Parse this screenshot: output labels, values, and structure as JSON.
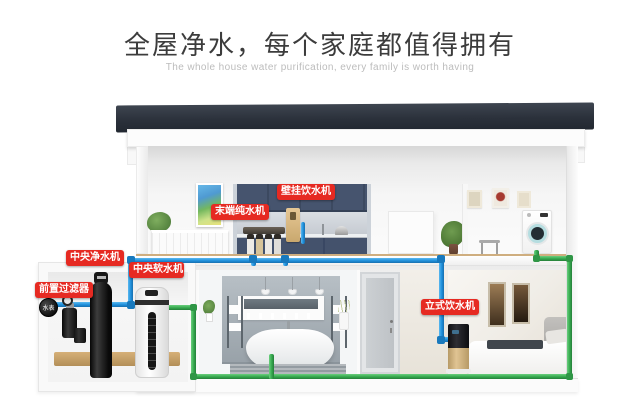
{
  "header": {
    "title": "全屋净水，每个家庭都值得拥有",
    "subtitle": "The whole house water purification, every family is worth having"
  },
  "callouts": {
    "wall_dispenser": "壁挂饮水机",
    "terminal_purifier": "末端纯水机",
    "central_purifier": "中央净水机",
    "central_softener": "中央软水机",
    "pre_filter": "前置过滤器",
    "standing_dispenser": "立式饮水机",
    "water_meter": "水表"
  },
  "colors": {
    "callout_red": "#e62a22",
    "pipe_blue": "#1f8fdb",
    "pipe_green": "#35a84e",
    "roof": "#2b313b",
    "cabinet_navy": "#46546e",
    "accent_gold": "#d0b285"
  }
}
